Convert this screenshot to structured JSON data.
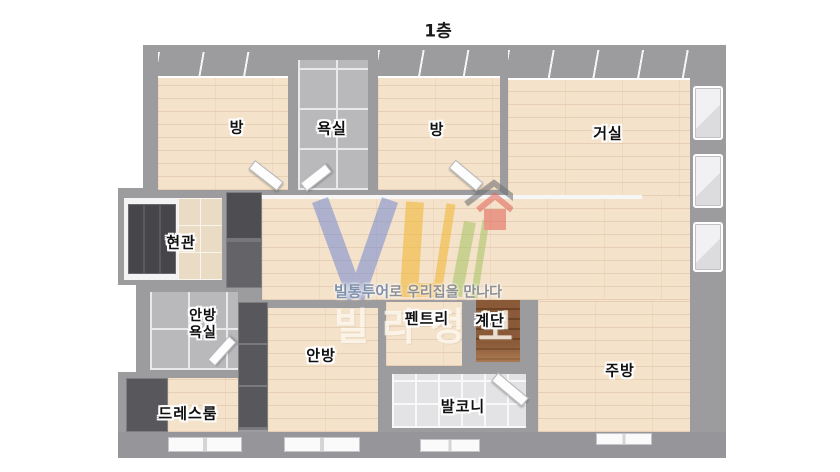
{
  "title": {
    "text": "1층"
  },
  "rooms": [
    {
      "id": "room-1",
      "label": "방"
    },
    {
      "id": "bathroom",
      "label": "욕실"
    },
    {
      "id": "room-2",
      "label": "방"
    },
    {
      "id": "living-room",
      "label": "거실"
    },
    {
      "id": "entrance",
      "label": "현관"
    },
    {
      "id": "master-bathroom",
      "lines": [
        "안방",
        "욕실"
      ]
    },
    {
      "id": "dress-room",
      "label": "드레스룸"
    },
    {
      "id": "master-bedroom",
      "label": "안방"
    },
    {
      "id": "pantry",
      "label": "펜트리"
    },
    {
      "id": "stairs",
      "label": "계단"
    },
    {
      "id": "balcony",
      "label": "발코니"
    },
    {
      "id": "kitchen",
      "label": "주방"
    }
  ],
  "watermark": {
    "tagline_brand": "빌통투어",
    "tagline_rest": "로 우리집을 만나다",
    "large_text": "빌라정보",
    "logo_colors": {
      "blue": "#7b8fd1",
      "yellow": "#f2b733",
      "green": "#a9c565",
      "red": "#e2675c"
    }
  },
  "palette": {
    "wall": "#9c9c9e",
    "wood_floor": "#f4e2ca",
    "bath_tile": "#b9b9bb",
    "balcony_tile": "#e3e3e5",
    "entrance_tile": "#eadcc4",
    "stairs": "#8a5a38",
    "furniture": "#58585c"
  }
}
